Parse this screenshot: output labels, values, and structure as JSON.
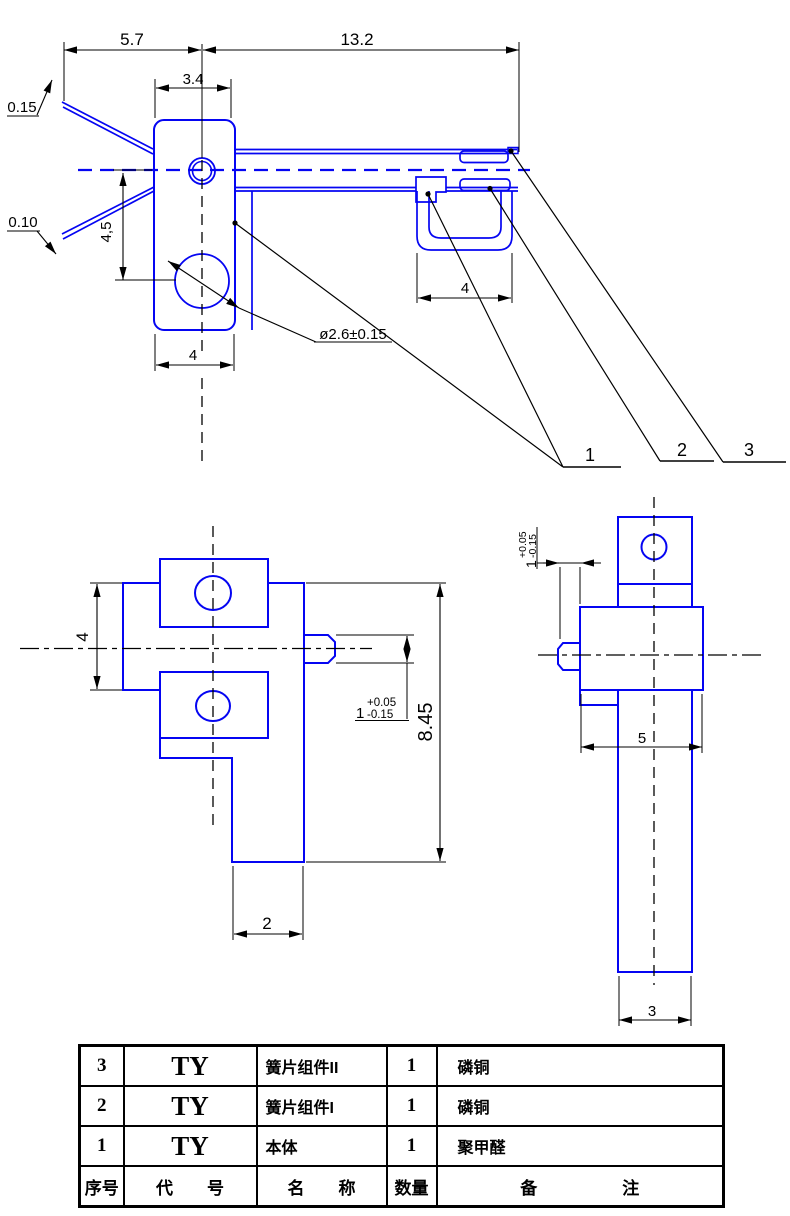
{
  "colors": {
    "part_line": "#0505f2",
    "annotation": "#000000",
    "background": "#ffffff"
  },
  "top_view": {
    "dim_left_span": "5.7",
    "dim_right_span": "13.2",
    "dim_body_width_top": "3.4",
    "dim_hole_offset": "4,5",
    "dim_body_width_bottom": "4",
    "dim_hook_width": "4",
    "dim_hole_dia": "ø2.6±0.15",
    "dim_leaf_upper_thickness": "0.15",
    "dim_leaf_lower_thickness": "0.10",
    "balloon_1": "1",
    "balloon_2": "2",
    "balloon_3": "3"
  },
  "front_view": {
    "dim_height": "4",
    "dim_total_height": "8.45",
    "dim_stem_width": "2",
    "tol": {
      "nominal": "1",
      "plus": "+0.05",
      "minus": "-0.15"
    }
  },
  "side_view": {
    "dim_body_width": "5",
    "dim_stem_width": "3",
    "tol": {
      "nominal": "1",
      "plus": "+0.05",
      "minus": "-0.15"
    }
  },
  "parts_table": {
    "headers": {
      "no": "序号",
      "code": "代　　号",
      "name": "名　　称",
      "qty": "数量",
      "note": "备　　　　　注"
    },
    "rows": [
      {
        "no": "3",
        "code": "TY",
        "name": "簧片组件II",
        "qty": "1",
        "note": "磷铜"
      },
      {
        "no": "2",
        "code": "TY",
        "name": "簧片组件I",
        "qty": "1",
        "note": "磷铜"
      },
      {
        "no": "1",
        "code": "TY",
        "name": "本体",
        "qty": "1",
        "note": "聚甲醛"
      }
    ]
  }
}
